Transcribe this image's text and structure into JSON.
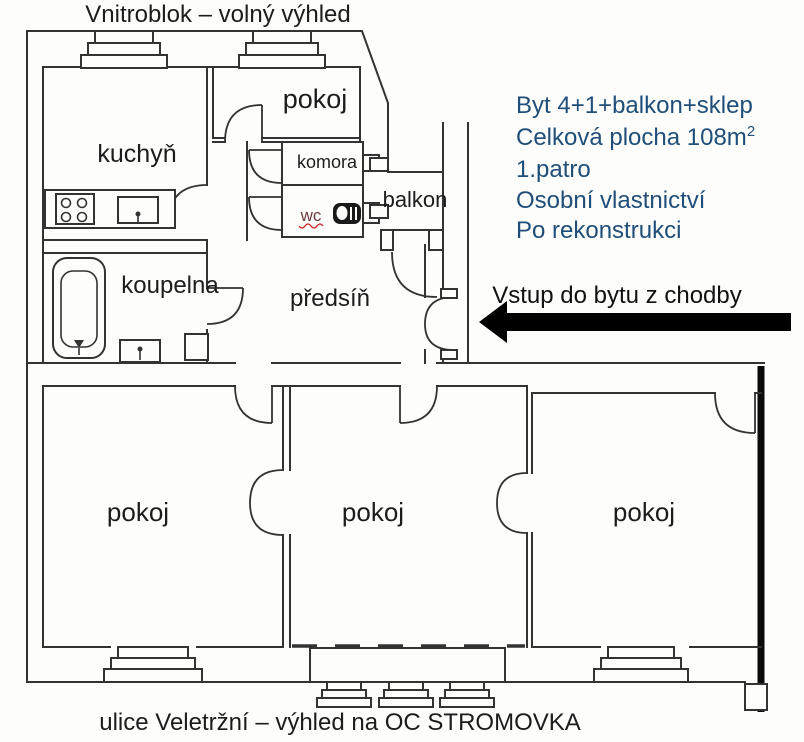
{
  "header": {
    "top_caption": "Vnitroblok – volný výhled"
  },
  "footer": {
    "bottom_caption": "ulice Veletržní – výhled na OC STROMOVKA"
  },
  "listing_info": {
    "text_color": "#1f4e79",
    "line1": "Byt 4+1+balkon+sklep",
    "line2_text": "Celková plocha 108m",
    "line2_superscript": "2",
    "line3": "1.patro",
    "line4": "Osobní vlastnictví",
    "line5": "Po rekonstrukci"
  },
  "entrance": {
    "label": "Vstup do bytu z chodby",
    "arrow_color": "#000000"
  },
  "floorplan": {
    "line_color": "#333333",
    "wc_underline_color": "#cc2222",
    "rooms": {
      "kitchen": "kuchyň",
      "room_top": "pokoj",
      "pantry": "komora",
      "wc": "wc",
      "balcony": "balkon",
      "bathroom": "koupelna",
      "hallway": "předsíň",
      "room_bottom_left": "pokoj",
      "room_bottom_middle": "pokoj",
      "room_bottom_right": "pokoj"
    }
  }
}
